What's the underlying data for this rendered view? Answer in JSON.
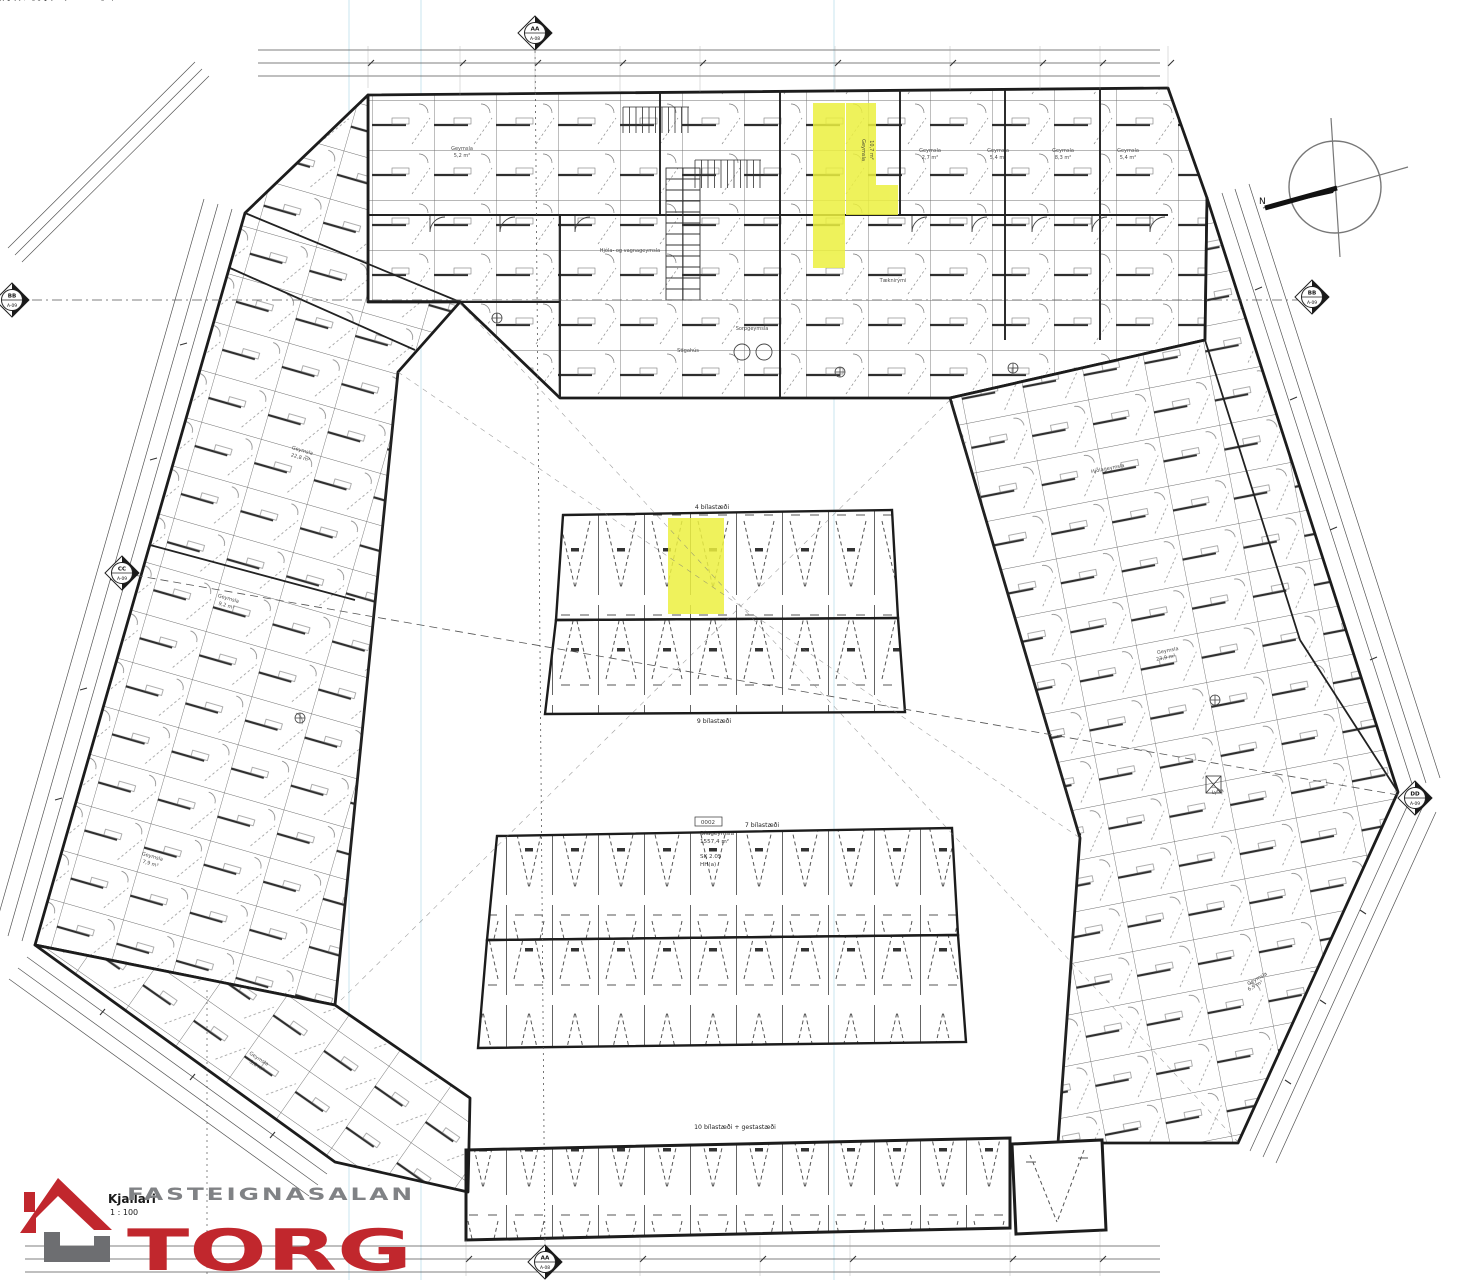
{
  "page": {
    "background": "#ffffff",
    "fold_line_color": "#cfe9f2",
    "ink": "#2a2a2a"
  },
  "drawing": {
    "title": "Kjallari",
    "scale": "1 : 100",
    "compass_label": "N",
    "highlight_color": "#ecf03f"
  },
  "logo": {
    "brand_top": "FASTEIGNASALAN",
    "brand_main": "TORG",
    "red": "#c1272d",
    "gray": "#808285"
  },
  "markers": [
    {
      "id": "AA",
      "sheet": "A-08",
      "x": 535,
      "y": 33
    },
    {
      "id": "AA",
      "sheet": "A-08",
      "x": 545,
      "y": 1262
    },
    {
      "id": "CC",
      "sheet": "A-09",
      "x": 122,
      "y": 573
    },
    {
      "id": "DD",
      "sheet": "A-09",
      "x": 1415,
      "y": 798
    },
    {
      "id": "BB",
      "sheet": "A-09",
      "x": 12,
      "y": 300
    },
    {
      "id": "BB",
      "sheet": "A-09",
      "x": 1312,
      "y": 297
    }
  ],
  "parking_labels": [
    {
      "t": "4 bílastæði",
      "x": 712,
      "y": 509
    },
    {
      "t": "9 bílastæði",
      "x": 714,
      "y": 723
    },
    {
      "t": "7 bílastæði",
      "x": 762,
      "y": 827
    },
    {
      "t": "10 bílastæði + gestastæði",
      "x": 735,
      "y": 1129
    }
  ],
  "center_note": {
    "lines": [
      "Bílgeymslan er varin með",
      "sjálfvirku vatnsúðakerfi",
      "",
      "Reykræsting bílgeymslu",
      "er skv. 0,1 %",
      "af loftrými bílgeymslu",
      "",
      "58 bílastæði",
      "þ.a.m. 2 stæði fyrir hreyfihamlaða og 1 þvottastæði"
    ],
    "unit_id": "0002",
    "unit_name": "Bílageymsla",
    "unit_area": "1557,4 m²",
    "code_1": "SK  2.05",
    "code_2": "HH(a)"
  },
  "room_labels": [
    {
      "t": "Geymsla",
      "x": 462,
      "y": 150
    },
    {
      "t": "5,2 m²",
      "x": 462,
      "y": 157
    },
    {
      "t": "Geymsla",
      "x": 930,
      "y": 152
    },
    {
      "t": "2,7 m²",
      "x": 930,
      "y": 159
    },
    {
      "t": "Geymsla",
      "x": 998,
      "y": 152
    },
    {
      "t": "5,4 m²",
      "x": 998,
      "y": 159
    },
    {
      "t": "Geymsla",
      "x": 1063,
      "y": 152
    },
    {
      "t": "8,3 m²",
      "x": 1063,
      "y": 159
    },
    {
      "t": "Geymsla",
      "x": 1128,
      "y": 152
    },
    {
      "t": "5,4 m²",
      "x": 1128,
      "y": 159
    },
    {
      "t": "Geymsla",
      "x": 862,
      "y": 150,
      "r": 90
    },
    {
      "t": "10,7 m²",
      "x": 870,
      "y": 150,
      "r": 90
    },
    {
      "t": "Hjóla- og vagnageymsla",
      "x": 630,
      "y": 252
    },
    {
      "t": "Sorpgeymsla",
      "x": 752,
      "y": 330
    },
    {
      "t": "Tæknirými",
      "x": 893,
      "y": 282
    },
    {
      "t": "Stigahús",
      "x": 688,
      "y": 352
    },
    {
      "t": "Hjólageymsla",
      "x": 1108,
      "y": 470,
      "r": -11
    },
    {
      "t": "Geymsla",
      "x": 302,
      "y": 452,
      "r": 16
    },
    {
      "t": "22,8 m²",
      "x": 300,
      "y": 459,
      "r": 16
    },
    {
      "t": "Geymsla",
      "x": 228,
      "y": 600,
      "r": 16
    },
    {
      "t": "9,2 m²",
      "x": 226,
      "y": 607,
      "r": 16
    },
    {
      "t": "Geymsla",
      "x": 152,
      "y": 858,
      "r": 16
    },
    {
      "t": "7,9 m²",
      "x": 150,
      "y": 865,
      "r": 16
    },
    {
      "t": "Geymsla",
      "x": 1168,
      "y": 652,
      "r": -11
    },
    {
      "t": "23,9 m²",
      "x": 1166,
      "y": 659,
      "r": -11
    },
    {
      "t": "Lyfta",
      "x": 1218,
      "y": 793,
      "r": -11
    },
    {
      "t": "Geymsla",
      "x": 1258,
      "y": 980,
      "r": -30
    },
    {
      "t": "6,9 m²",
      "x": 1256,
      "y": 987,
      "r": -30
    },
    {
      "t": "Geymsla",
      "x": 258,
      "y": 1060,
      "r": 33
    },
    {
      "t": "5,8 m²",
      "x": 256,
      "y": 1067,
      "r": 33
    }
  ]
}
